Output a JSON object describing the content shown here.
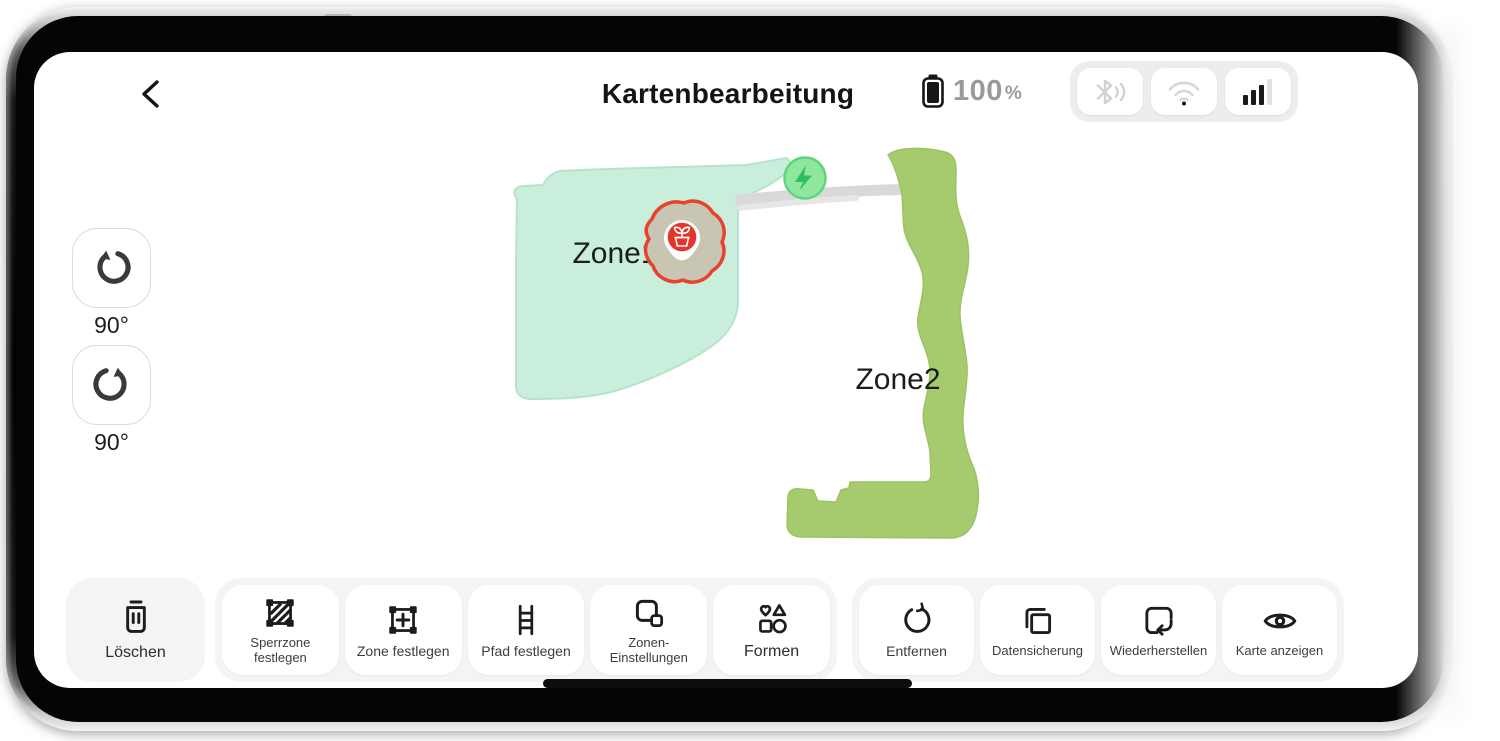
{
  "header": {
    "title": "Kartenbearbeitung",
    "battery": {
      "percent": "100",
      "unit": "%"
    },
    "status_icons": [
      "bluetooth-icon",
      "wifi-icon",
      "signal-bars-icon"
    ]
  },
  "rotation_controls": {
    "counterclockwise_label": "90°",
    "clockwise_label": "90°"
  },
  "map": {
    "zones": [
      {
        "label": "Zone1",
        "fill": "#c9efdc"
      },
      {
        "label": "Zone2",
        "fill": "#a6cb6e"
      }
    ],
    "marker": {
      "icon": "plant-pot-icon",
      "accent": "#e5352b",
      "blob_fill": "#c8c5b3"
    },
    "charger": {
      "icon": "lightning-bolt-icon",
      "fill": "#8ee79d"
    },
    "path_color": "#d9d9d9"
  },
  "toolbar": {
    "delete": {
      "label": "Löschen",
      "icon": "trash-icon"
    },
    "zone_tools": [
      {
        "label": "Sperrzone festlegen",
        "icon": "no-zone-icon"
      },
      {
        "label": "Zone festlegen",
        "icon": "add-zone-icon"
      },
      {
        "label": "Pfad festlegen",
        "icon": "ladder-path-icon"
      },
      {
        "label": "Zonen-Einstellungen",
        "icon": "zone-settings-icon"
      },
      {
        "label": "Formen",
        "icon": "shapes-icon"
      }
    ],
    "map_tools": [
      {
        "label": "Entfernen",
        "icon": "reset-circle-icon"
      },
      {
        "label": "Datensicherung",
        "icon": "copy-icon"
      },
      {
        "label": "Wiederherstellen",
        "icon": "restore-icon"
      },
      {
        "label": "Karte anzeigen",
        "icon": "eye-icon"
      }
    ]
  }
}
